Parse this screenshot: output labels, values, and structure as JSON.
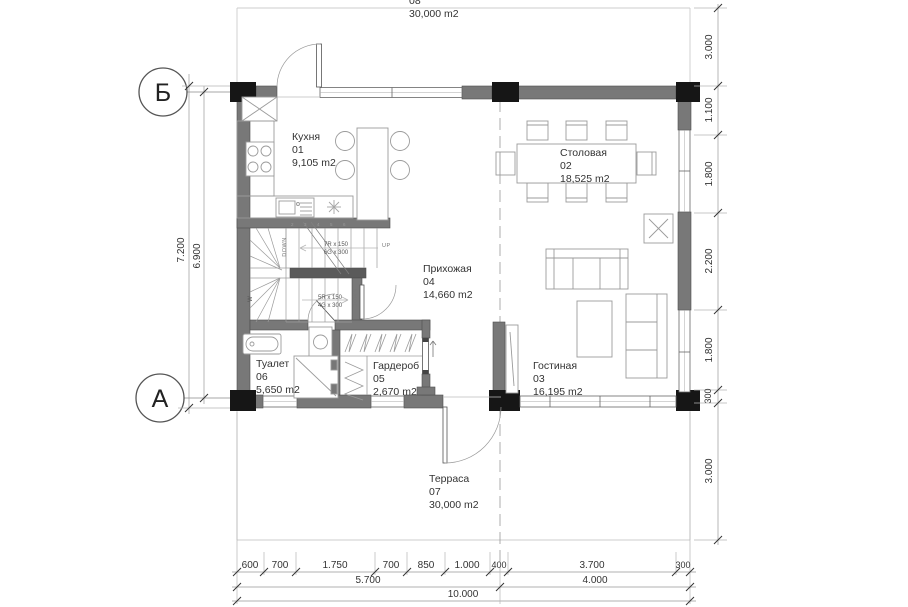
{
  "grid": {
    "b": "Б",
    "a": "А"
  },
  "rooms": {
    "balcony_top": {
      "number": "08",
      "area": "30,000 m2"
    },
    "kitchen": {
      "name": "Кухня",
      "number": "01",
      "area": "9,105 m2"
    },
    "dining": {
      "name": "Столовая",
      "number": "02",
      "area": "18,525 m2"
    },
    "living": {
      "name": "Гостиная",
      "number": "03",
      "area": "16,195 m2"
    },
    "hallway": {
      "name": "Прихожая",
      "number": "04",
      "area": "14,660 m2"
    },
    "wardrobe": {
      "name": "Гардероб",
      "number": "05",
      "area": "2,670 m2"
    },
    "toilet": {
      "name": "Туалет",
      "number": "06",
      "area": "5,650 m2"
    },
    "terrace": {
      "name": "Терраса",
      "number": "07",
      "area": "30,000 m2"
    }
  },
  "stairs": {
    "u1": "7R x 150",
    "u2": "6G x 300",
    "l1": "5R x 150",
    "l2": "4G x 300",
    "down_left": "DOWN",
    "down_right": "DOWN",
    "up": "UP",
    "winder": "W",
    "treads": [
      "2",
      "3",
      "4",
      "5",
      "6"
    ]
  },
  "dims": {
    "left": [
      "7.200",
      "6.900"
    ],
    "right": [
      "3.000",
      "1.100",
      "1.800",
      "2.200",
      "1.800",
      "300",
      "3.000"
    ],
    "bottom_segments": [
      "600",
      "700",
      "1.750",
      "700",
      "850",
      "1.000",
      "400",
      "3.700",
      "300"
    ],
    "bottom_totals": [
      "5.700",
      "4.000"
    ],
    "bottom_overall": "10.000"
  },
  "colors": {
    "wall": "#787878",
    "column": "#161616",
    "line": "#999999"
  }
}
